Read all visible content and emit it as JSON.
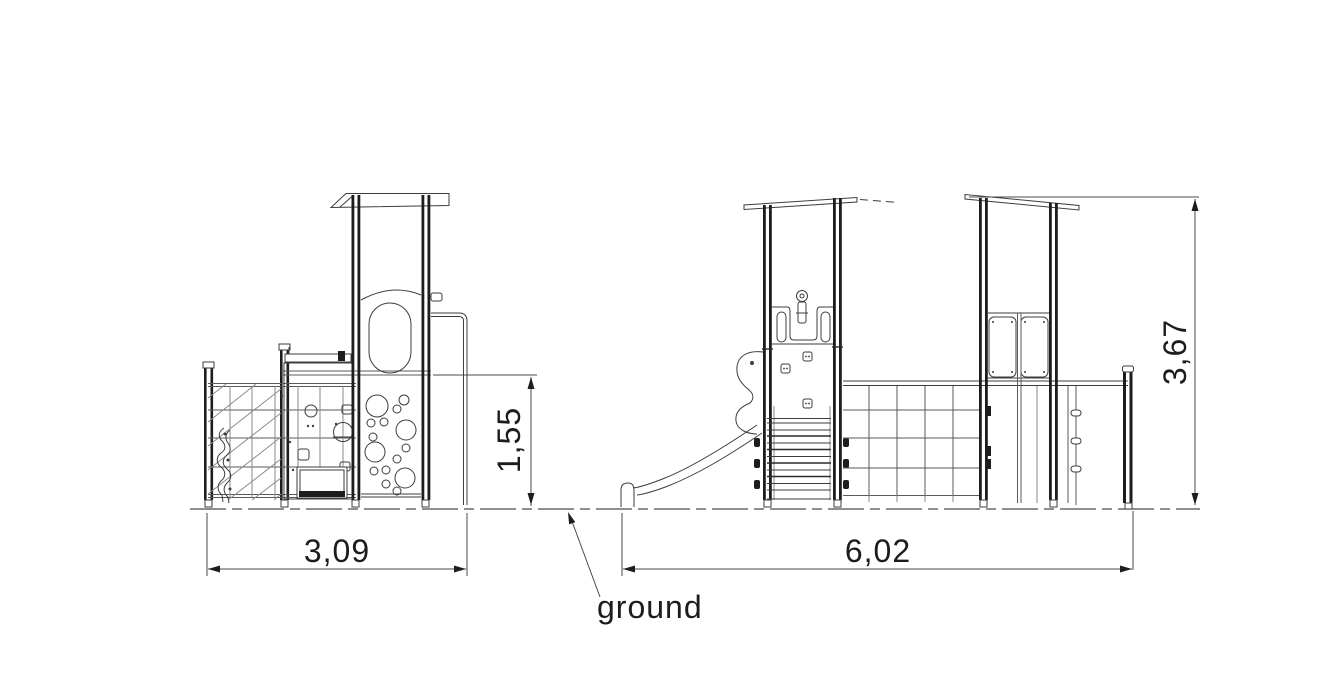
{
  "document": {
    "type": "technical-elevation-drawing",
    "subject": "playground tower unit, two elevation views with dimensions",
    "views": [
      "side elevation",
      "front elevation"
    ]
  },
  "dimensions": {
    "left_width": "3,09",
    "platform_height": "1,55",
    "total_width": "6,02",
    "total_height": "3,67"
  },
  "labels": {
    "ground": "ground"
  },
  "colors": {
    "background": "#ffffff",
    "line": "#3d3d3d",
    "heavy_line": "#1d1d1d",
    "dimension": "#4a4a4a",
    "text": "#1c1c1c"
  }
}
